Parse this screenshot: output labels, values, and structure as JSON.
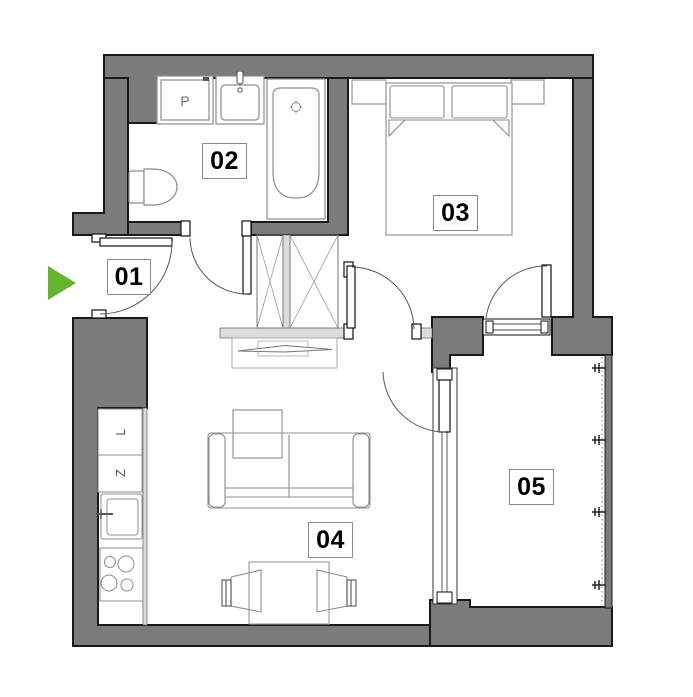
{
  "floor_plan": {
    "kind": "apartment-floor-plan",
    "rooms": {
      "room1_label": "01",
      "room2_label": "02",
      "room3_label": "03",
      "room4_label": "04",
      "room5_label": "05"
    },
    "appliances": {
      "washer_label": "P",
      "kitchen_cabinet_l_label": "L",
      "kitchen_cabinet_z_label": "Z"
    },
    "colors": {
      "wall_fill": "#7b7b7b",
      "wall_outline": "#1a1a1a",
      "partition_fill": "#dcdcdc",
      "furniture_line": "#8d8d8d",
      "entrance_arrow_green": "#66b42d"
    }
  }
}
